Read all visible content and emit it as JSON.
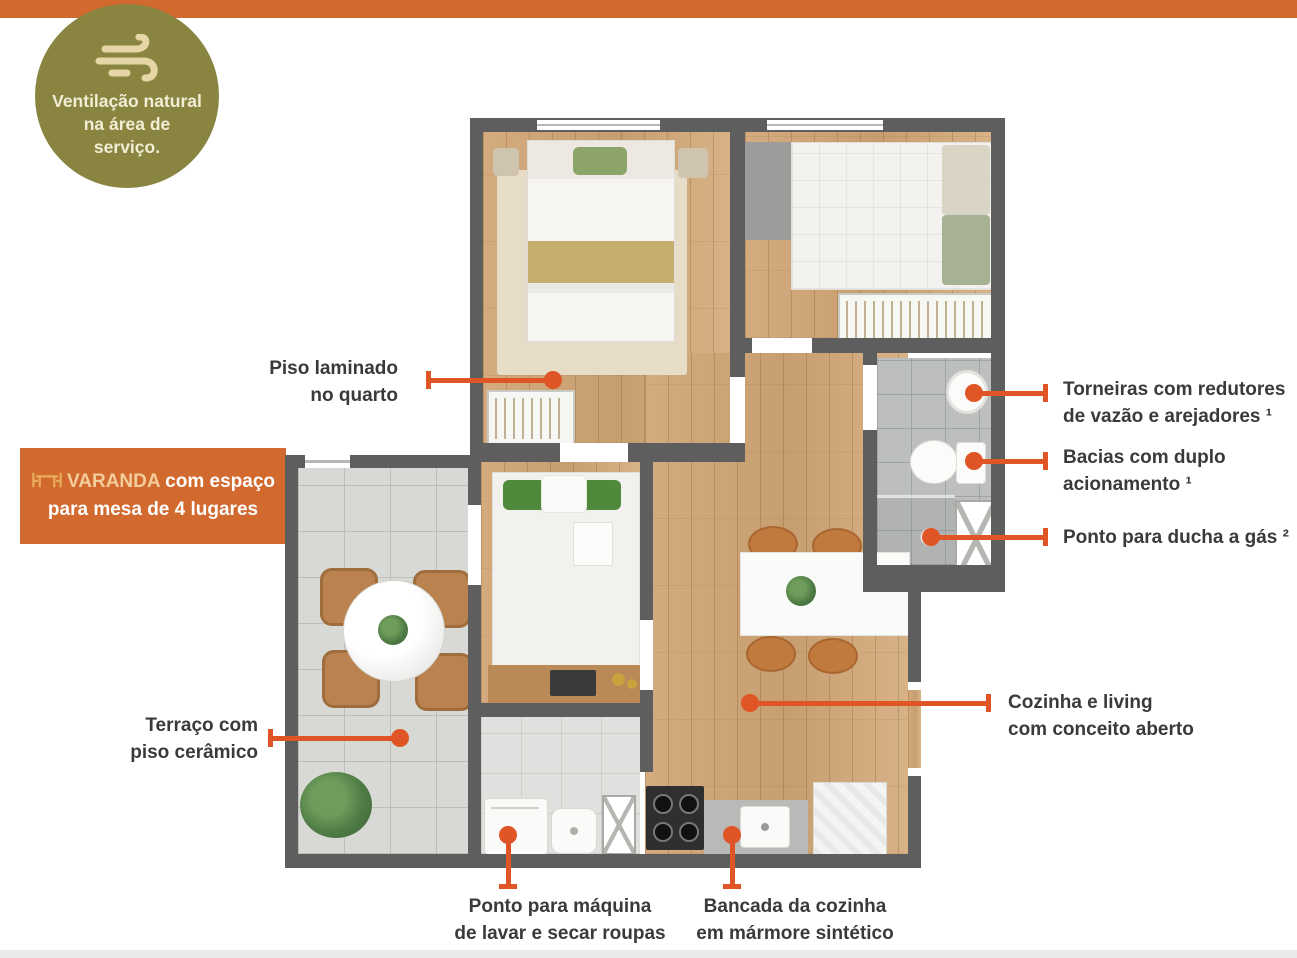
{
  "top_bar": {
    "color": "#D2692F"
  },
  "bottom_bar": {
    "color": "#EAEAE8"
  },
  "badge": {
    "icon": "wind-icon",
    "bg_color": "#8A8441",
    "icon_color": "#E7D6A5",
    "text_color": "#F2EDD4",
    "line1": "Ventilação natural",
    "line2": "na área de",
    "line3": "serviço."
  },
  "banner": {
    "icon": "table-chairs-icon",
    "bg_color": "#D2692F",
    "brand": "VARANDA",
    "brand_color": "#F3CD9A",
    "line1_rest": " com espaço",
    "line2": "para mesa de 4 lugares",
    "text_color": "#FFFFFF"
  },
  "callouts": {
    "piso_laminado": {
      "line1": "Piso laminado",
      "line2": "no quarto"
    },
    "torneiras": {
      "line1": "Torneiras com redutores",
      "line2": "de vazão e arejadores ¹"
    },
    "bacias": {
      "line1": "Bacias com duplo",
      "line2": "acionamento ¹"
    },
    "ducha": {
      "line1": "Ponto para ducha a gás ²"
    },
    "cozinha": {
      "line1": "Cozinha e living",
      "line2": "com conceito aberto"
    },
    "terraco": {
      "line1": "Terraço com",
      "line2": "piso cerâmico"
    },
    "maquina": {
      "line1": "Ponto para máquina",
      "line2": "de lavar e secar roupas"
    },
    "bancada": {
      "line1": "Bancada da cozinha",
      "line2": "em mármore sintético"
    }
  },
  "leader_color": "#E05526",
  "callout_text_color": "#3C3A39",
  "plan_colors": {
    "wall": "#5E5E5E",
    "wood_floor": "#CDA377",
    "terrace_tile": "#D8D9D5",
    "bathroom_tile": "#BCBFBE",
    "laundry_floor": "#E0E0DE"
  }
}
